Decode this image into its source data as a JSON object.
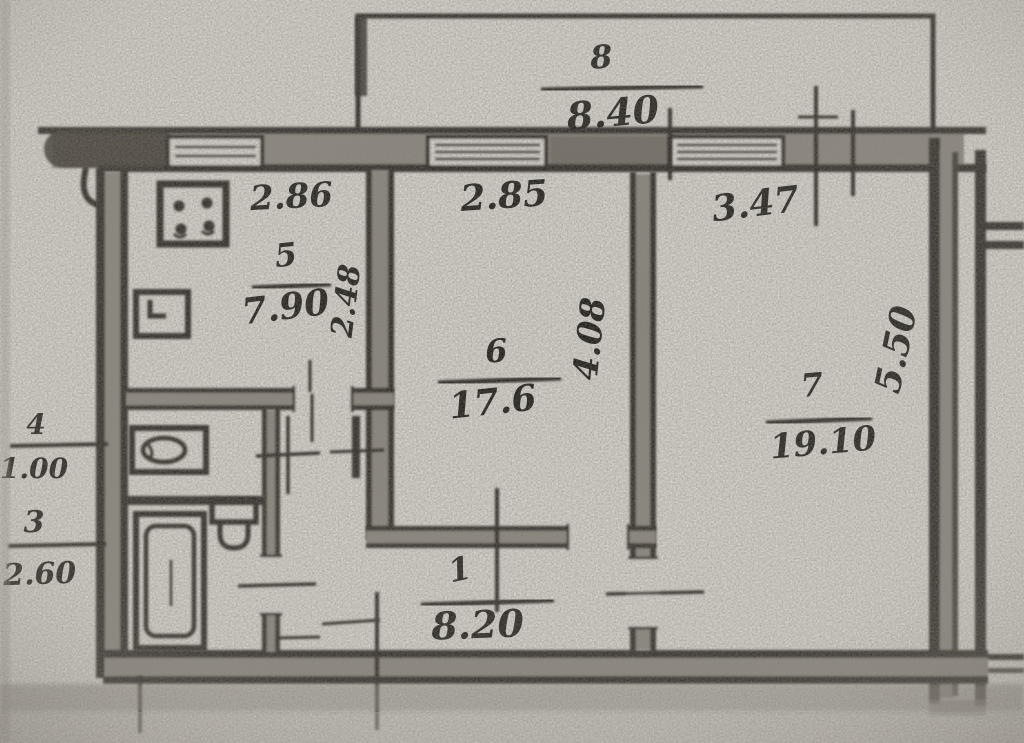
{
  "document": {
    "type": "scanned hand-drawn apartment floor plan",
    "orientation": "landscape"
  },
  "labels": {
    "balcony": {
      "number": "8",
      "area": "8.40"
    },
    "kitchen": {
      "width": "2.86",
      "number": "5",
      "area": "7.90",
      "depth": "2.48"
    },
    "room6": {
      "width": "2.85",
      "number": "6",
      "area": "17.6",
      "depth": "4.08"
    },
    "room7": {
      "width": "3.47",
      "number": "7",
      "area": "19.10",
      "depth": "5.50"
    },
    "toilet": {
      "number": "4",
      "area": "1.00"
    },
    "bathroom": {
      "number": "3",
      "area": "2.60"
    },
    "hall": {
      "number": "1",
      "area": "8.20"
    }
  },
  "icons": [
    "stove-icon",
    "kitchen-sink-icon",
    "washbasin-icon",
    "toilet-icon",
    "bathtub-icon",
    "window-icon",
    "balcony-outline"
  ],
  "colors": {
    "paper": "#d8d5ce",
    "ink": "#26231e",
    "wall_fill": "#8a857c",
    "shadow": "#8d8880"
  }
}
